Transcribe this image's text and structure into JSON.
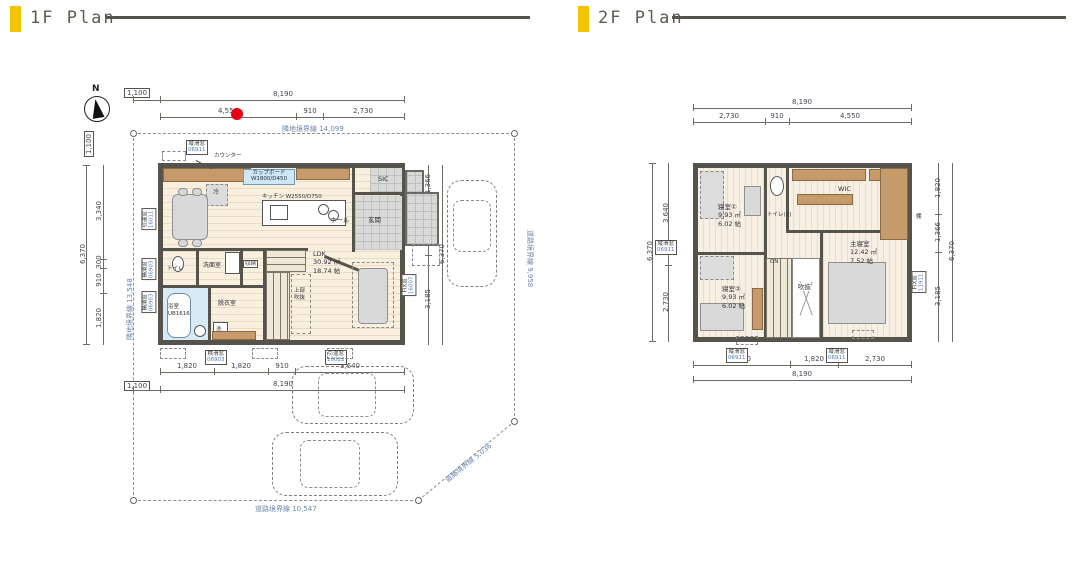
{
  "headers": {
    "f1": "1F Plan",
    "f2": "2F Plan"
  },
  "colors": {
    "accent_yellow": "#F2C400",
    "header_rule": "#55534a",
    "wall": "#56524c",
    "red_marker": "#e60012",
    "boundary_text": "#6b87a8",
    "window_code_text": "#4a7ab8"
  },
  "f1": {
    "compass_label": "N",
    "boundaries": {
      "top": "隣地境界線 14,099",
      "left": "隣地境界線 13,548",
      "right": "道路境界線 9,958",
      "bottom": "道路境界線 10,547",
      "diagonal": "道路境界線 5,036"
    },
    "dims": {
      "top_offset": "1,100",
      "top_total": "8,190",
      "top_sub": [
        "4,550",
        "910",
        "2,730"
      ],
      "left_offset": "1,100",
      "left_total": "6,370",
      "left_sub": [
        "3,340",
        "300",
        "910",
        "1,820"
      ],
      "right_total": "6,370",
      "right_sub": [
        "1,366",
        "1,820",
        "3,185"
      ],
      "bottom_sub": [
        "1,820",
        "1,820",
        "910",
        "3,640"
      ],
      "bottom_offset": "1,100",
      "bottom_total": "8,190"
    },
    "windows": {
      "top": {
        "name": "縦滑窓",
        "code": "06911"
      },
      "left_upper": {
        "name": "引違窓",
        "code": "16011"
      },
      "left_mid": {
        "name": "横滑窓",
        "code": "06903"
      },
      "left_lower": {
        "name": "横滑窓",
        "code": "06903"
      },
      "bottom": {
        "name": "横滑窓",
        "code": "06903"
      },
      "bottom_right": {
        "name": "引違窓",
        "code": "16022"
      },
      "right": {
        "name": "FIX窓",
        "code": "16007"
      }
    },
    "labels": {
      "counter": "カウンター",
      "cupboard": "カップボード",
      "cupboard_size": "W1800/D450",
      "fridge": "冷",
      "kitchen": "キッチン W2550/D750",
      "hall": "ホール",
      "entrance": "玄関",
      "sic": "SIC",
      "toilet": "トイレ",
      "washroom": "洗面室",
      "storage": "収納",
      "dressing": "脱衣室",
      "bath": "浴室",
      "bath_model": "UB1616",
      "washer": "洗",
      "ldk": "LDK",
      "ldk_m2": "30.92 ㎡",
      "ldk_jo": "18.74 帖",
      "void_above_1": "上部",
      "void_above_2": "吹抜"
    }
  },
  "f2": {
    "dims": {
      "top_total": "8,190",
      "top_sub": [
        "2,730",
        "910",
        "4,550"
      ],
      "left_total": "6,370",
      "left_sub": [
        "3,640",
        "2,730"
      ],
      "right_total": "6,370",
      "right_sub": [
        "1,820",
        "1,366",
        "3,185"
      ],
      "bottom_sub": [
        "3,640",
        "1,820",
        "2,730"
      ],
      "bottom_total": "8,190"
    },
    "windows": {
      "left": {
        "name": "縦滑窓",
        "code": "06911"
      },
      "right": {
        "name": "FIX窓",
        "code": "11911"
      },
      "bottom_left": {
        "name": "縦滑窓",
        "code": "06911"
      },
      "bottom_right": {
        "name": "縦滑窓",
        "code": "06911"
      }
    },
    "labels": {
      "bedroom1": "寝室①",
      "bedroom1_m2": "9.93 ㎡",
      "bedroom1_jo": "6.02 帖",
      "toilet2": "トイレ(2)",
      "wic": "WIC",
      "master": "主寝室",
      "master_m2": "12.42 ㎡",
      "master_jo": "7.52 帖",
      "bedroom2": "寝室②",
      "bedroom2_m2": "9.93 ㎡",
      "bedroom2_jo": "6.02 帖",
      "void": "吹抜",
      "down": "DN",
      "shelf": "棚"
    }
  }
}
